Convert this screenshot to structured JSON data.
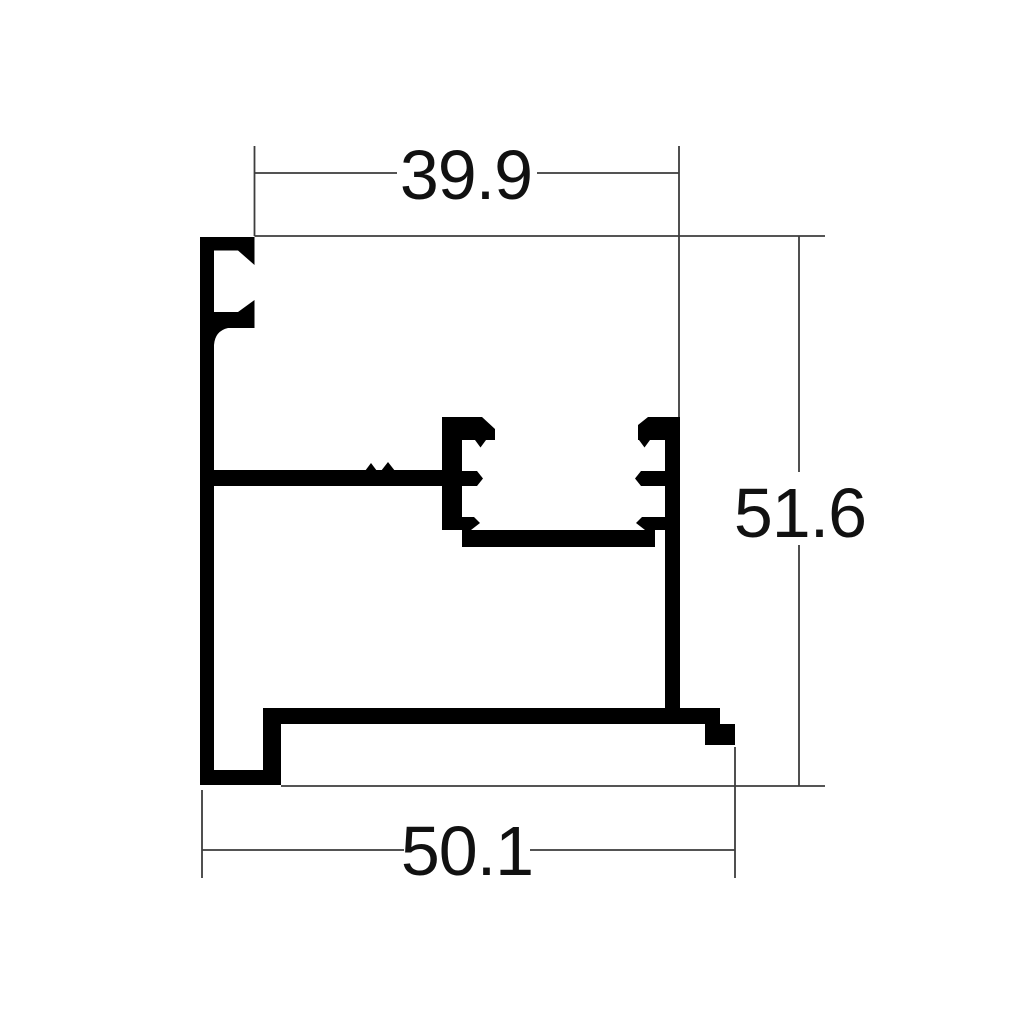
{
  "drawing": {
    "background_color": "#ffffff",
    "profile_color": "#000000",
    "dimension_line_color": "#3d3d3d",
    "text_color": "#111111",
    "dimensions": {
      "top_width": "39.9",
      "right_height": "51.6",
      "bottom_width": "50.1"
    }
  }
}
